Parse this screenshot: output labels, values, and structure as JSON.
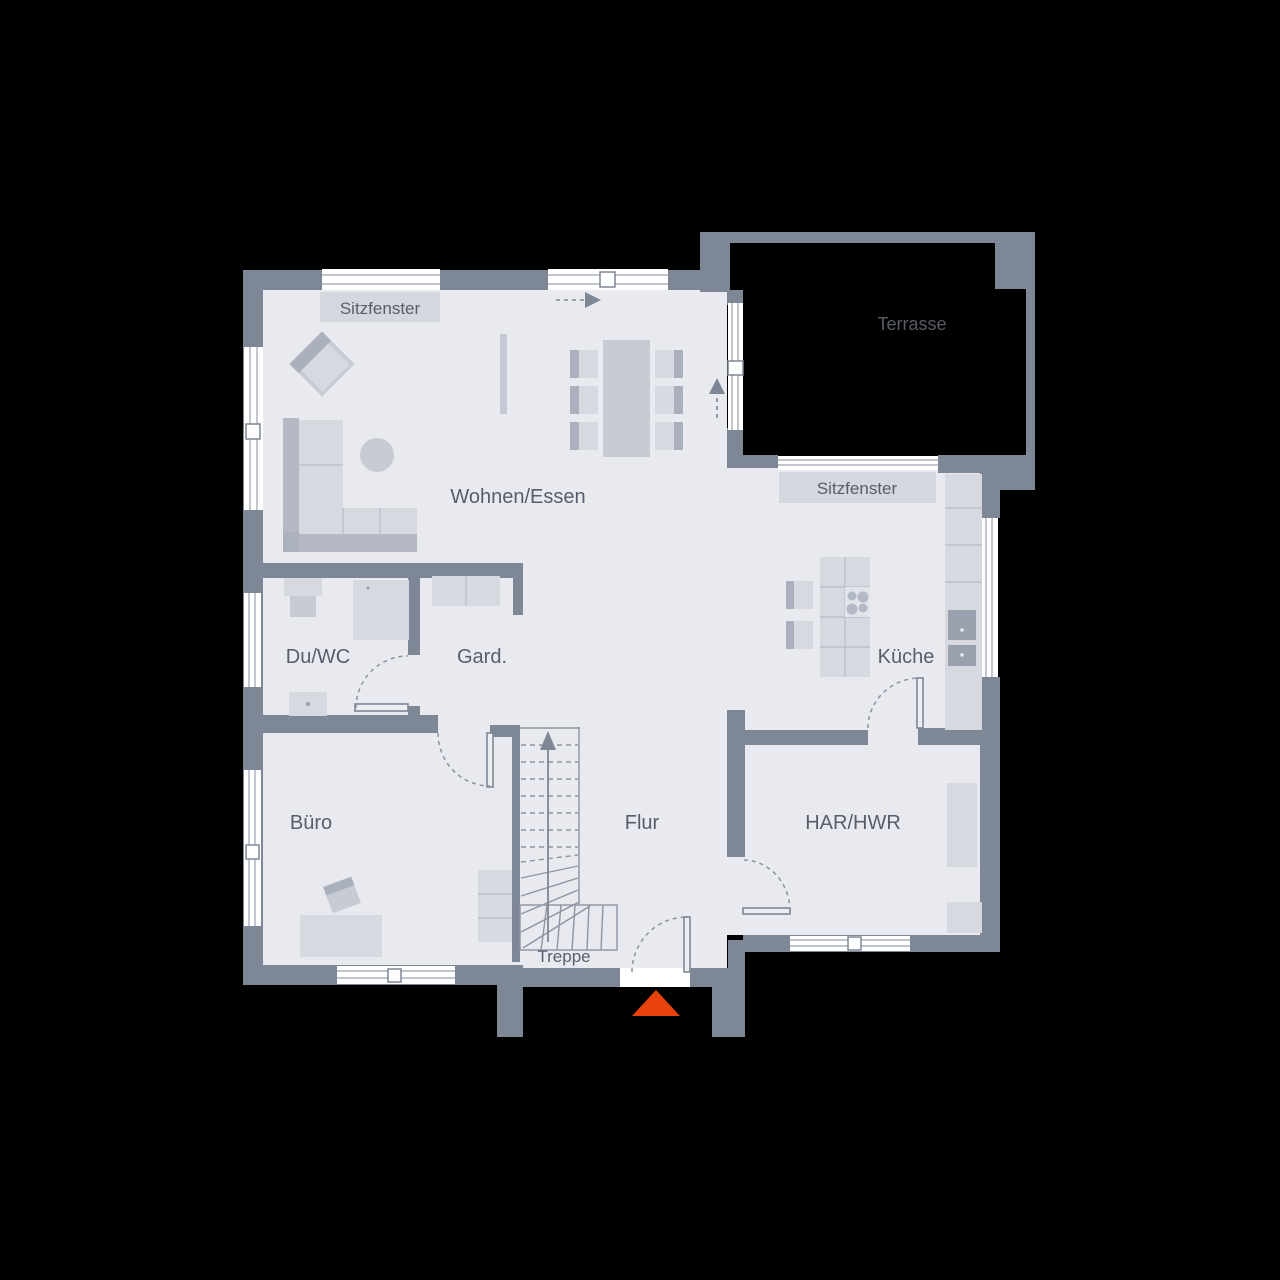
{
  "plan": {
    "type": "floor-plan",
    "rooms": {
      "wohnen_essen": {
        "label": "Wohnen/Essen"
      },
      "du_wc": {
        "label": "Du/WC"
      },
      "gard": {
        "label": "Gard."
      },
      "kueche": {
        "label": "Küche"
      },
      "buero": {
        "label": "Büro"
      },
      "flur": {
        "label": "Flur"
      },
      "har_hwr": {
        "label": "HAR/HWR"
      },
      "treppe": {
        "label": "Treppe"
      },
      "terrasse": {
        "label": "Terrasse"
      }
    },
    "window_labels": {
      "sitzfenster_top": {
        "label": "Sitzfenster"
      },
      "sitzfenster_terrace": {
        "label": "Sitzfenster"
      }
    },
    "icons": {
      "entrance_marker": "orange-triangle-up",
      "stair_direction": "arrow-up-solid-line",
      "exit_direction_top": "dashed-arrow-right",
      "exit_direction_terrace": "dashed-arrow-up",
      "door_swings": "dashed-quarter-arc"
    },
    "colors": {
      "background": "#000000",
      "wall": "#7e8795",
      "floor": "#e8eaef",
      "window": "#ffffff",
      "furniture_light": "#d6d9e0",
      "furniture_mid": "#c6cbd4",
      "furniture_dark": "#aab0bc",
      "label_box": "#d4d7de",
      "text": "#565e6c",
      "terrace_text": "#585c64",
      "accent": "#e8430e"
    }
  }
}
